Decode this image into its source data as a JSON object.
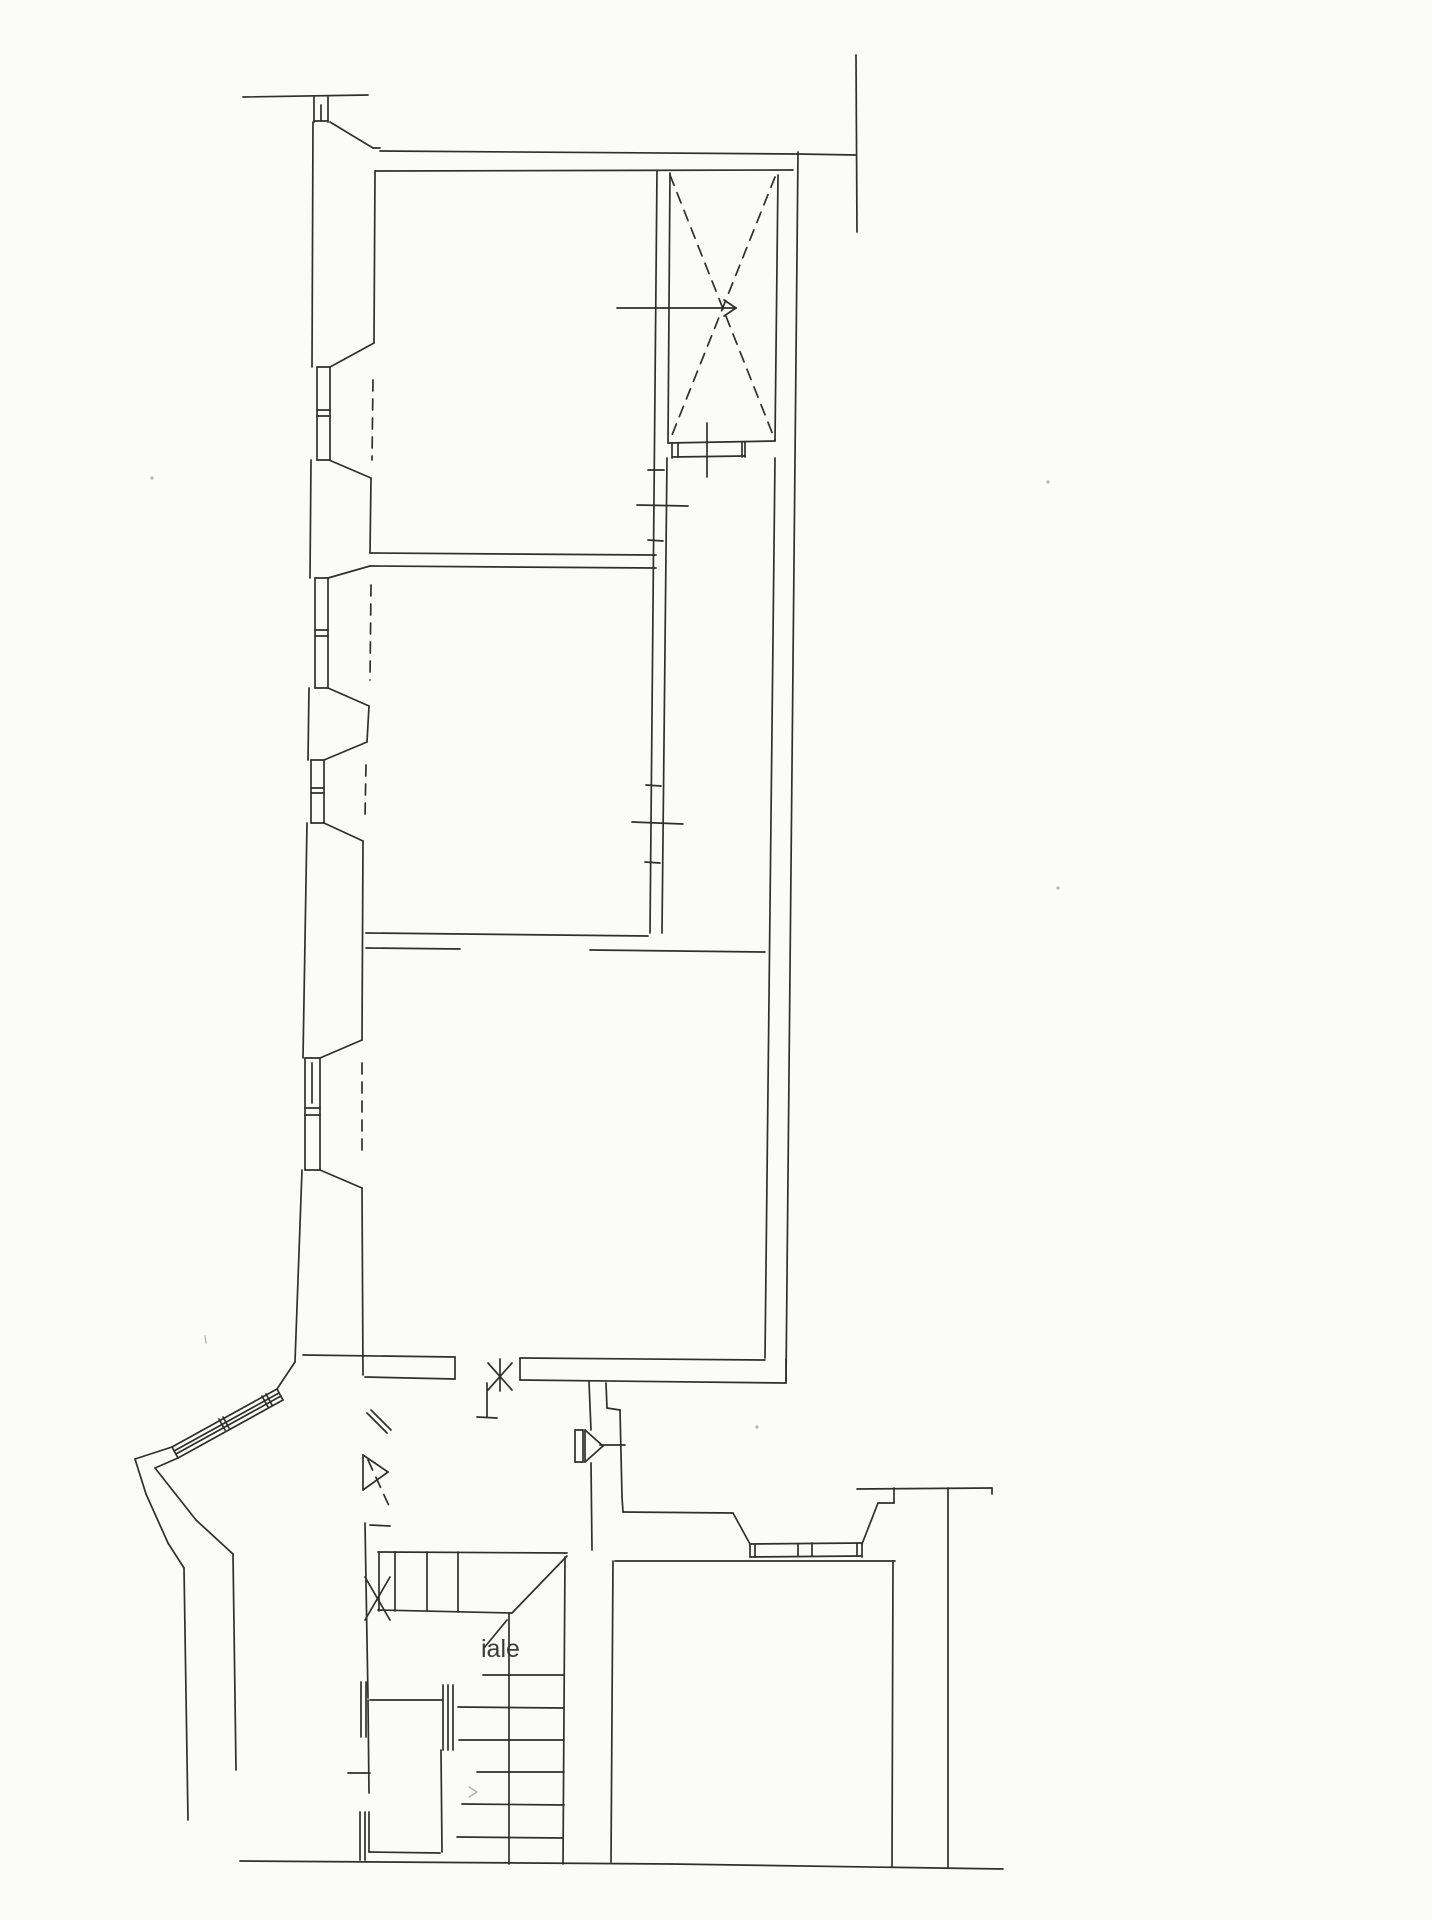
{
  "page": {
    "background": "#fbfbf9",
    "ink": "#2f2f2f",
    "faint": "#b5b5b0"
  },
  "floorplan": {
    "canvas": {
      "width": 1432,
      "height": 1920
    },
    "stroke_width": 1.7,
    "labels": [
      {
        "text": "iale",
        "x": 481,
        "y": 1657,
        "size": 25,
        "color": "#3a3a3a"
      }
    ],
    "lines": [
      [
        243,
        97,
        368,
        95
      ],
      [
        314,
        96,
        314,
        122
      ],
      [
        328,
        96,
        328,
        122
      ],
      [
        314,
        121,
        328,
        121
      ],
      [
        321,
        105,
        321,
        121
      ],
      [
        313,
        122,
        312,
        367
      ],
      [
        330,
        122,
        373,
        148
      ],
      [
        373,
        148,
        380,
        148
      ],
      [
        380,
        151,
        798,
        154
      ],
      [
        798,
        154,
        856,
        155
      ],
      [
        856,
        55,
        857,
        232
      ],
      [
        375,
        171,
        793,
        170
      ],
      [
        311,
        460,
        310,
        578
      ],
      [
        309,
        688,
        308,
        760
      ],
      [
        307,
        823,
        303,
        1058
      ],
      [
        302,
        1170,
        295,
        1362
      ],
      [
        317,
        367,
        317,
        460
      ],
      [
        330,
        367,
        330,
        460
      ],
      [
        317,
        367,
        330,
        367
      ],
      [
        317,
        460,
        330,
        460
      ],
      [
        317,
        410,
        330,
        410
      ],
      [
        317,
        416,
        330,
        416
      ],
      [
        315,
        578,
        315,
        688
      ],
      [
        328,
        578,
        328,
        688
      ],
      [
        315,
        578,
        328,
        578
      ],
      [
        315,
        688,
        328,
        688
      ],
      [
        315,
        630,
        328,
        630
      ],
      [
        315,
        636,
        328,
        636
      ],
      [
        311,
        760,
        311,
        823
      ],
      [
        324,
        760,
        324,
        823
      ],
      [
        311,
        760,
        324,
        760
      ],
      [
        311,
        823,
        324,
        823
      ],
      [
        311,
        788,
        324,
        788
      ],
      [
        311,
        793,
        324,
        793
      ],
      [
        305,
        1058,
        305,
        1170
      ],
      [
        320,
        1058,
        320,
        1170
      ],
      [
        305,
        1058,
        320,
        1058
      ],
      [
        305,
        1170,
        320,
        1170
      ],
      [
        305,
        1108,
        320,
        1108
      ],
      [
        305,
        1115,
        320,
        1115
      ],
      [
        312,
        1063,
        312,
        1103
      ],
      [
        375,
        171,
        374,
        343
      ],
      [
        374,
        343,
        330,
        367
      ],
      [
        329,
        460,
        371,
        478
      ],
      [
        371,
        478,
        370,
        553
      ],
      [
        370,
        566,
        328,
        578
      ],
      [
        328,
        688,
        369,
        706
      ],
      [
        369,
        706,
        367,
        742
      ],
      [
        367,
        742,
        324,
        760
      ],
      [
        324,
        823,
        363,
        841
      ],
      [
        363,
        841,
        362,
        1040
      ],
      [
        362,
        1040,
        320,
        1058
      ],
      [
        320,
        1170,
        362,
        1188
      ],
      [
        362,
        1188,
        363,
        1375
      ],
      [
        370,
        553,
        656,
        555
      ],
      [
        370,
        566,
        656,
        568
      ],
      [
        657,
        171,
        650,
        933
      ],
      [
        670,
        173,
        668,
        443
      ],
      [
        667,
        458,
        662,
        933
      ],
      [
        637,
        505,
        688,
        506
      ],
      [
        632,
        822,
        683,
        824
      ],
      [
        648,
        470,
        664,
        470
      ],
      [
        648,
        540,
        663,
        541
      ],
      [
        646,
        785,
        661,
        786
      ],
      [
        645,
        862,
        660,
        863
      ],
      [
        778,
        175,
        775,
        441
      ],
      [
        668,
        443,
        775,
        441
      ],
      [
        672,
        443,
        672,
        458
      ],
      [
        678,
        443,
        678,
        457
      ],
      [
        742,
        442,
        742,
        457
      ],
      [
        745,
        442,
        745,
        457
      ],
      [
        672,
        457,
        745,
        456
      ],
      [
        707,
        423,
        707,
        477
      ],
      [
        617,
        308,
        736,
        308
      ],
      [
        736,
        308,
        724,
        300
      ],
      [
        736,
        308,
        724,
        316
      ],
      [
        798,
        152,
        786,
        1381
      ],
      [
        775,
        458,
        765,
        1358
      ],
      [
        366,
        933,
        648,
        936
      ],
      [
        366,
        948,
        460,
        949
      ],
      [
        590,
        950,
        765,
        952
      ],
      [
        303,
        1355,
        455,
        1357
      ],
      [
        520,
        1358,
        765,
        1360
      ],
      [
        365,
        1377,
        455,
        1379
      ],
      [
        520,
        1380,
        786,
        1383
      ],
      [
        786,
        1359,
        786,
        1383
      ],
      [
        455,
        1357,
        455,
        1379
      ],
      [
        520,
        1358,
        520,
        1380
      ],
      [
        500,
        1359,
        500,
        1391
      ],
      [
        488,
        1390,
        512,
        1363
      ],
      [
        488,
        1363,
        512,
        1390
      ],
      [
        487,
        1383,
        487,
        1417
      ],
      [
        477,
        1417,
        497,
        1418
      ],
      [
        589,
        1382,
        591,
        1430
      ],
      [
        591,
        1463,
        592,
        1550
      ],
      [
        606,
        1383,
        607,
        1408
      ],
      [
        607,
        1408,
        620,
        1410
      ],
      [
        620,
        1410,
        622,
        1497
      ],
      [
        575,
        1430,
        583,
        1430
      ],
      [
        575,
        1462,
        583,
        1462
      ],
      [
        575,
        1430,
        575,
        1462
      ],
      [
        583,
        1430,
        583,
        1462
      ],
      [
        585,
        1430,
        603,
        1446
      ],
      [
        585,
        1462,
        603,
        1446
      ],
      [
        585,
        1430,
        585,
        1462
      ],
      [
        600,
        1445,
        625,
        1445
      ],
      [
        622,
        1497,
        623,
        1512
      ],
      [
        623,
        1512,
        733,
        1513
      ],
      [
        733,
        1513,
        750,
        1544
      ],
      [
        862,
        1544,
        878,
        1503
      ],
      [
        878,
        1503,
        894,
        1503
      ],
      [
        894,
        1488,
        894,
        1503
      ],
      [
        857,
        1489,
        992,
        1488
      ],
      [
        992,
        1488,
        992,
        1494
      ],
      [
        750,
        1544,
        750,
        1557
      ],
      [
        862,
        1543,
        862,
        1557
      ],
      [
        750,
        1544,
        862,
        1543
      ],
      [
        750,
        1557,
        862,
        1556
      ],
      [
        798,
        1544,
        798,
        1556
      ],
      [
        812,
        1543,
        812,
        1556
      ],
      [
        755,
        1544,
        755,
        1557
      ],
      [
        857,
        1543,
        857,
        1556
      ],
      [
        615,
        1561,
        895,
        1561
      ],
      [
        613,
        1561,
        611,
        1862
      ],
      [
        893,
        1561,
        892,
        1866
      ],
      [
        948,
        1488,
        948,
        1868
      ],
      [
        240,
        1861,
        672,
        1864
      ],
      [
        672,
        1864,
        1003,
        1869
      ],
      [
        378,
        1552,
        567,
        1553
      ],
      [
        379,
        1552,
        379,
        1611
      ],
      [
        395,
        1552,
        395,
        1611
      ],
      [
        427,
        1552,
        427,
        1611
      ],
      [
        458,
        1552,
        458,
        1612
      ],
      [
        378,
        1610,
        512,
        1613
      ],
      [
        512,
        1613,
        567,
        1556
      ],
      [
        507,
        1620,
        484,
        1648
      ],
      [
        509,
        1613,
        509,
        1864
      ],
      [
        565,
        1557,
        563,
        1864
      ],
      [
        483,
        1675,
        564,
        1675
      ],
      [
        458,
        1707,
        564,
        1708
      ],
      [
        459,
        1740,
        564,
        1740
      ],
      [
        477,
        1772,
        564,
        1772
      ],
      [
        462,
        1804,
        564,
        1805
      ],
      [
        457,
        1837,
        563,
        1838
      ],
      [
        370,
        1700,
        442,
        1700
      ],
      [
        368,
        1700,
        369,
        1793
      ],
      [
        369,
        1812,
        369,
        1852
      ],
      [
        369,
        1852,
        440,
        1853
      ],
      [
        441,
        1750,
        442,
        1852
      ],
      [
        443,
        1685,
        443,
        1750
      ],
      [
        448,
        1685,
        448,
        1750
      ],
      [
        453,
        1685,
        453,
        1750
      ],
      [
        348,
        1773,
        370,
        1773
      ],
      [
        361,
        1682,
        361,
        1737
      ],
      [
        366,
        1682,
        366,
        1737
      ],
      [
        360,
        1812,
        360,
        1860
      ],
      [
        365,
        1812,
        365,
        1860
      ],
      [
        365,
        1523,
        368,
        1698
      ],
      [
        370,
        1525,
        390,
        1526
      ],
      [
        365,
        1577,
        390,
        1620
      ],
      [
        365,
        1620,
        390,
        1577
      ],
      [
        363,
        1455,
        363,
        1490
      ],
      [
        363,
        1455,
        388,
        1472
      ],
      [
        363,
        1490,
        388,
        1472
      ],
      [
        367,
        1413,
        387,
        1433
      ],
      [
        371,
        1410,
        391,
        1430
      ],
      [
        295,
        1362,
        277,
        1389
      ],
      [
        277,
        1389,
        172,
        1447
      ],
      [
        283,
        1400,
        178,
        1458
      ],
      [
        279,
        1393,
        174,
        1451
      ],
      [
        281,
        1396,
        176,
        1454
      ],
      [
        277,
        1389,
        283,
        1400
      ],
      [
        172,
        1447,
        178,
        1458
      ],
      [
        262,
        1396,
        268,
        1407
      ],
      [
        266,
        1394,
        272,
        1405
      ],
      [
        219,
        1419,
        225,
        1430
      ],
      [
        223,
        1417,
        229,
        1428
      ],
      [
        172,
        1447,
        135,
        1459
      ],
      [
        135,
        1459,
        146,
        1494
      ],
      [
        146,
        1494,
        168,
        1543
      ],
      [
        168,
        1543,
        184,
        1568
      ],
      [
        184,
        1568,
        188,
        1820
      ],
      [
        178,
        1458,
        155,
        1468
      ],
      [
        155,
        1468,
        196,
        1520
      ],
      [
        196,
        1520,
        233,
        1554
      ],
      [
        233,
        1554,
        236,
        1770
      ]
    ],
    "dashed": [
      [
        373,
        380,
        372,
        460
      ],
      [
        371,
        585,
        370,
        680
      ],
      [
        366,
        765,
        365,
        818
      ],
      [
        362,
        1063,
        362,
        1157
      ],
      [
        670,
        175,
        775,
        440
      ],
      [
        775,
        177,
        670,
        440
      ],
      [
        368,
        1460,
        390,
        1508
      ]
    ],
    "faint_lines": [
      [
        469,
        1787,
        477,
        1792
      ],
      [
        469,
        1797,
        477,
        1792
      ],
      [
        205,
        1336,
        206,
        1343
      ]
    ],
    "speckles": [
      [
        152,
        478
      ],
      [
        1048,
        482
      ],
      [
        1058,
        888
      ],
      [
        757,
        1427
      ]
    ]
  }
}
